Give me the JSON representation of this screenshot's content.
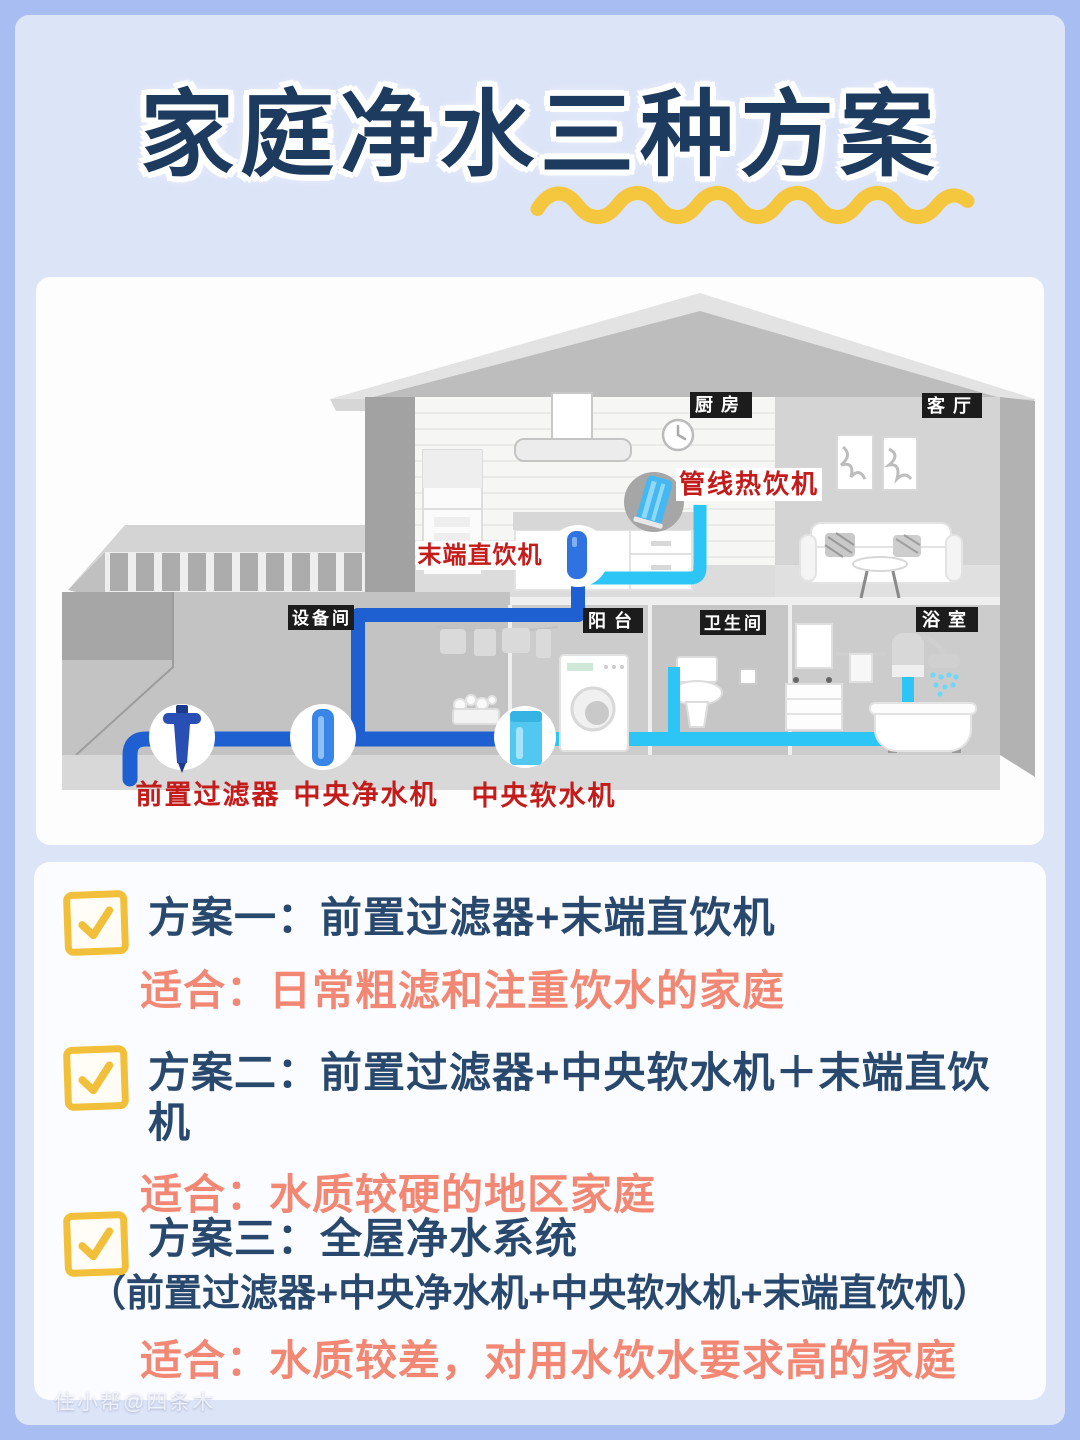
{
  "header": {
    "title": "家庭净水三种方案"
  },
  "diagram": {
    "room_labels": {
      "kitchen": "厨房",
      "living_room": "客厅",
      "utility_room": "设备间",
      "balcony": "阳台",
      "toilet": "卫生间",
      "bathroom": "浴室"
    },
    "device_labels": {
      "pipeline_hot_dispenser": "管线热饮机",
      "terminal_drinking_machine": "末端直饮机",
      "pre_filter": "前置过滤器",
      "central_water_purifier": "中央净水机",
      "central_water_softener": "中央软水机"
    }
  },
  "plans": [
    {
      "title": "方案一：前置过滤器+末端直饮机",
      "fit": "适合：日常粗滤和注重饮水的家庭"
    },
    {
      "title": "方案二：前置过滤器+中央软水机＋末端直饮机",
      "fit": "适合：水质较硬的地区家庭"
    },
    {
      "title": "方案三：全屋净水系统",
      "subtitle": "（前置过滤器+中央净水机+中央软水机+末端直饮机）",
      "fit": "适合：水质较差，对用水饮水要求高的家庭"
    }
  ],
  "watermark": "住小帮@四条木",
  "colors": {
    "background": "#a8bef2",
    "panel": "#dce4f8",
    "accent_yellow": "#f1bf3a",
    "navy": "#28496d",
    "coral": "#f28874",
    "label_red": "#c41b1b",
    "pipe_blue": "#1e60d2",
    "pipe_cyan": "#2cc5f5"
  },
  "icons": {
    "checkbox_check": "✓"
  }
}
